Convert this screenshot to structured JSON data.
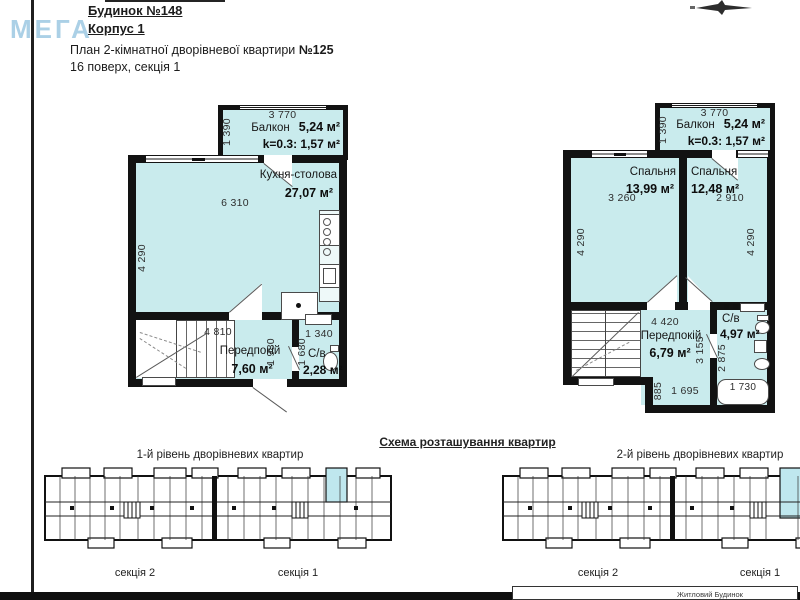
{
  "header": {
    "building_no": "Будинок №148",
    "block": "Корпус 1",
    "watermark": "МЕГА",
    "plan_title": "План 2-кімнатної дворівневої квартири ",
    "plan_no": "№125",
    "floor_info": "16 поверх, секція 1"
  },
  "level1": {
    "balcony": {
      "name": "Балкон",
      "area": "5,24 м²",
      "coef": "k=0.3: 1,57 м²",
      "width": "3 770",
      "height": "1 390"
    },
    "kitchen": {
      "name": "Кухня-столова",
      "area": "27,07 м²",
      "width": "6 310",
      "height": "4 290"
    },
    "hallway": {
      "name": "Передпокій",
      "area": "7,60 м²",
      "width": "4 810",
      "height": "1 980"
    },
    "bathroom": {
      "name": "С/в",
      "area": "2,28 м²",
      "width": "1 340",
      "height": "1 680"
    }
  },
  "level2": {
    "balcony": {
      "name": "Балкон",
      "area": "5,24 м²",
      "coef": "k=0.3: 1,57 м²",
      "width": "3 770",
      "height": "1 390"
    },
    "bedroom_left": {
      "name": "Спальня",
      "area": "13,99 м²",
      "width": "3 260",
      "height": "4 290"
    },
    "bedroom_right": {
      "name": "Спальня",
      "area": "12,48 м²",
      "width": "2 910",
      "height": "4 290"
    },
    "hallway": {
      "name": "Передпокій",
      "area": "6,79 м²",
      "width": "4 420",
      "height": "3 155",
      "dim_bottom_left": "885",
      "dim_bottom": "1 695"
    },
    "bathroom": {
      "name": "С/в",
      "area": "4,97 м²",
      "height": "2 875",
      "tub_width": "1 730"
    }
  },
  "schemes": {
    "title": "Схема розташування квартир",
    "caption_level1": "1-й рівень дворівневих квартир",
    "caption_level2": "2-й рівень дворівневих квартир",
    "section_1": "секція 1",
    "section_2": "секція 2"
  },
  "footer": {
    "label": "Житловий Будинок"
  },
  "colors": {
    "room_fill": "#c9ebed",
    "wall": "#121212",
    "highlight": "#bfe7ee",
    "watermark": "#7fb7d9"
  }
}
